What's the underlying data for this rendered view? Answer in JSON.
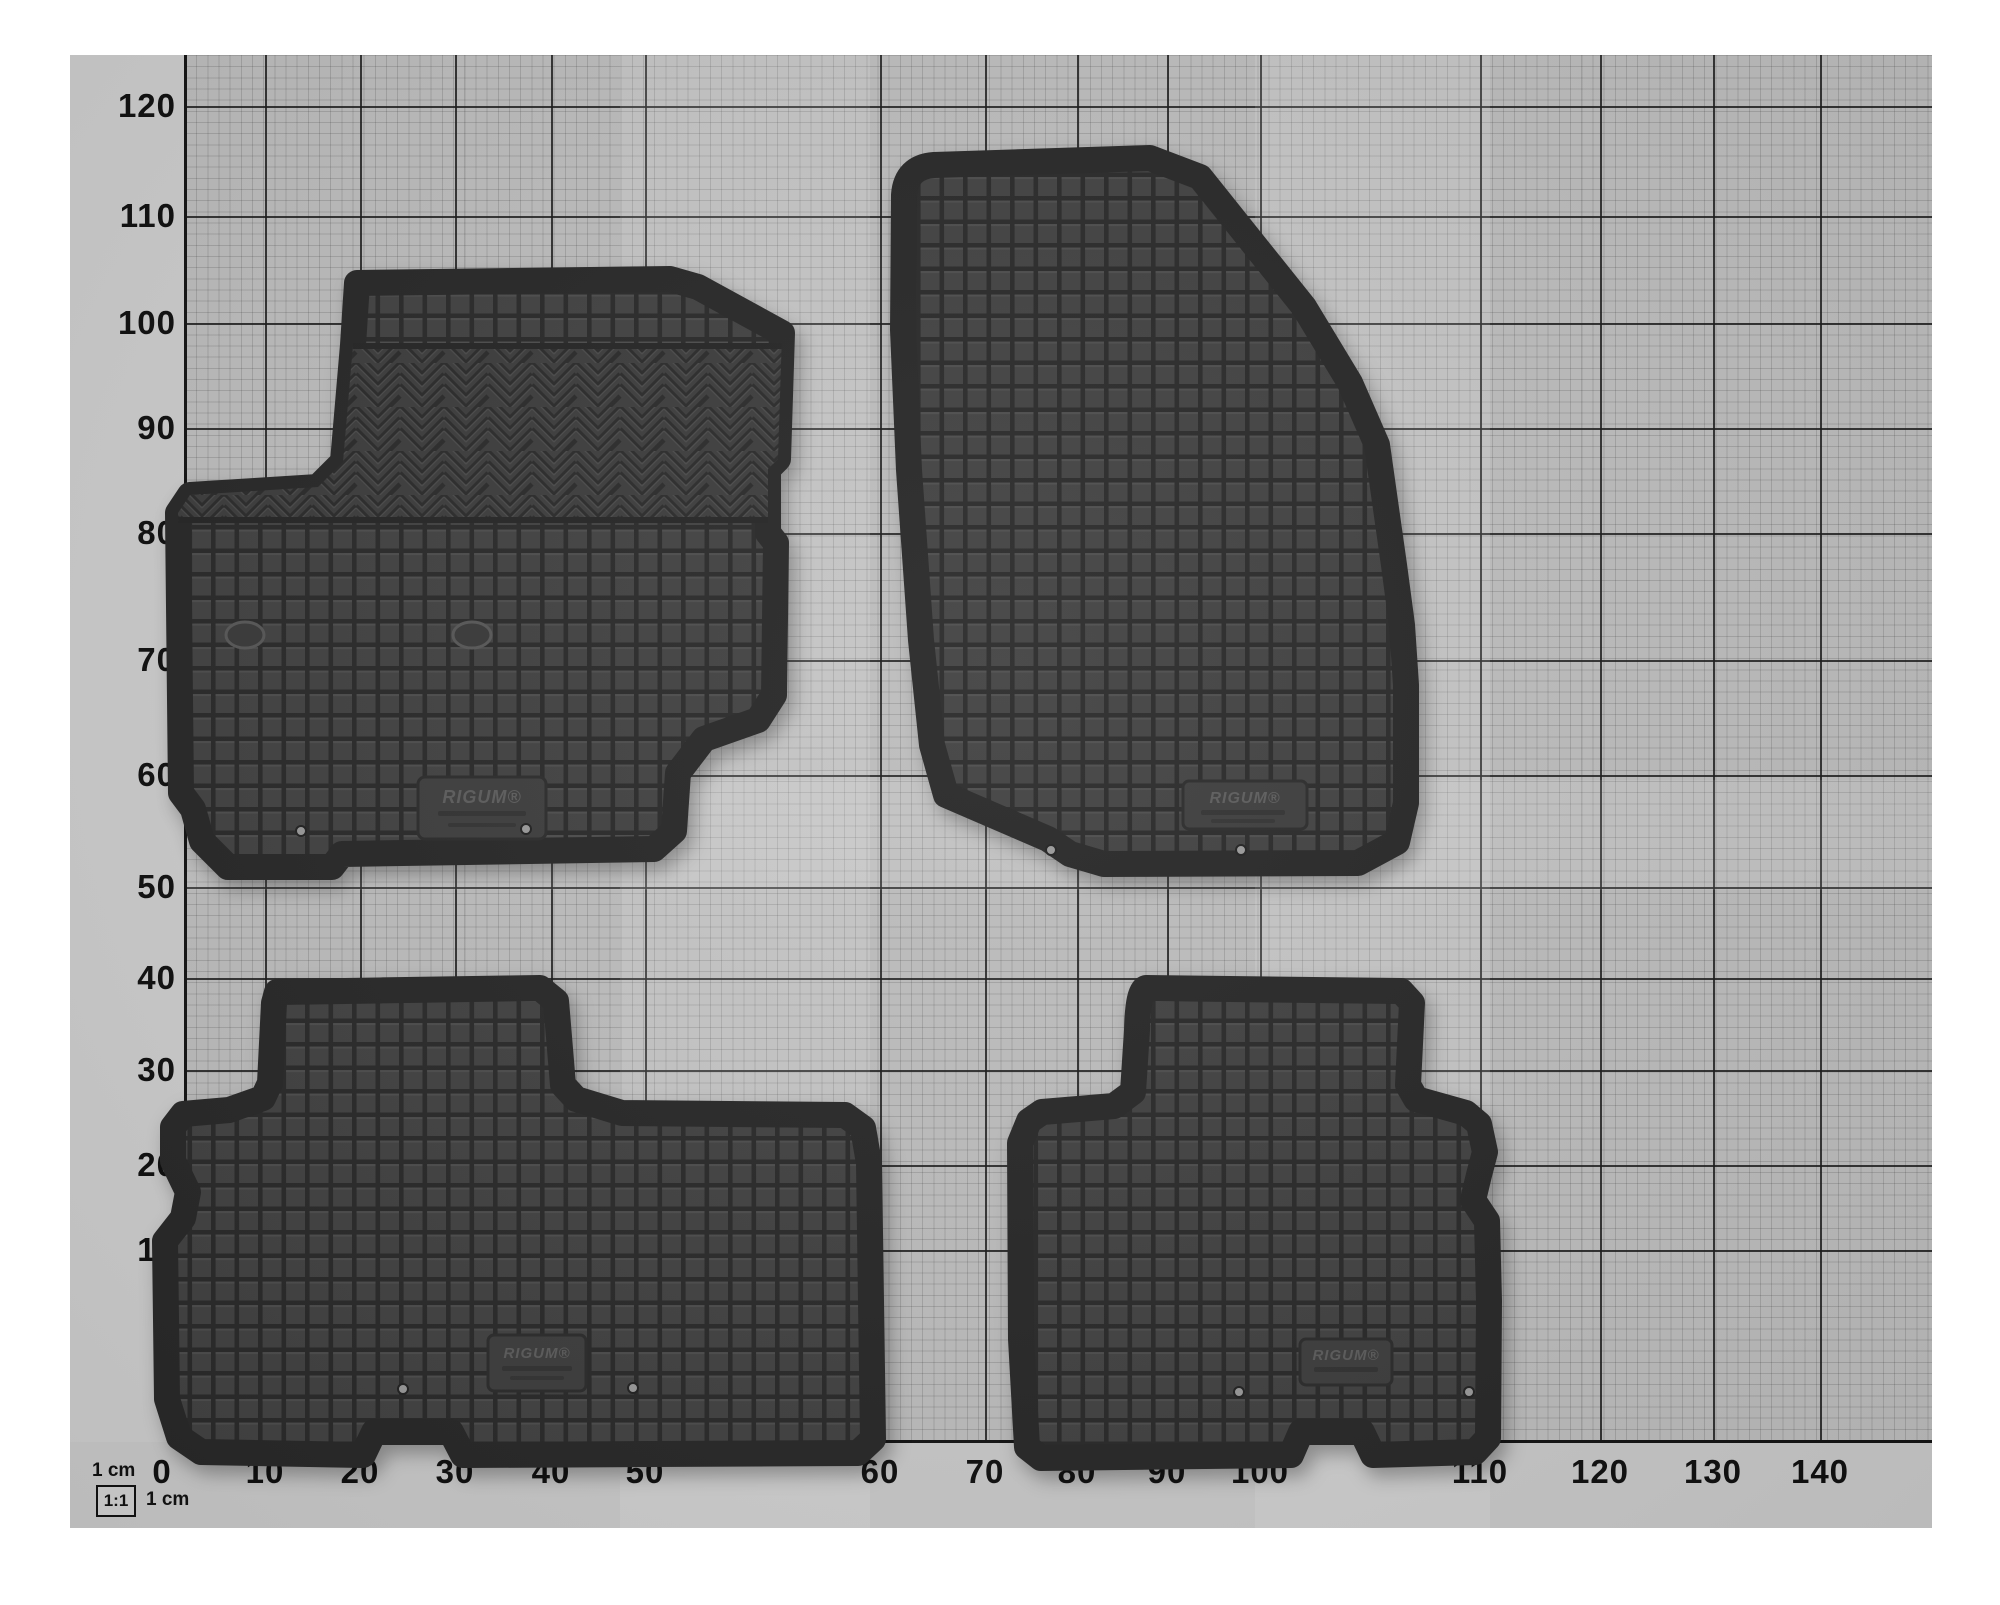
{
  "axes": {
    "x_labels": [
      "0",
      "10",
      "20",
      "30",
      "40",
      "50",
      "60",
      "70",
      "80",
      "90",
      "100",
      "110",
      "120",
      "130",
      "140"
    ],
    "y_labels": [
      "120",
      "110",
      "100",
      "90",
      "80",
      "70",
      "60",
      "50",
      "40",
      "30",
      "20",
      "10"
    ]
  },
  "scale_legend": {
    "top_label": "1 cm",
    "ratio_label": "1:1",
    "side_label": "1 cm"
  },
  "mats": [
    {
      "name": "front left floor mat",
      "plate_text": "RIGUM®"
    },
    {
      "name": "front right floor mat",
      "plate_text": "RIGUM®"
    },
    {
      "name": "rear left floor mat",
      "plate_text": "RIGUM®"
    },
    {
      "name": "rear right floor mat",
      "plate_text": "RIGUM®"
    }
  ],
  "colors": {
    "photo_bg": "#bfbfbf",
    "grid_major": "#1b1b1b",
    "mat_field": "#424242",
    "mat_groove": "#2a2a2a",
    "mat_rim": "#282828"
  }
}
